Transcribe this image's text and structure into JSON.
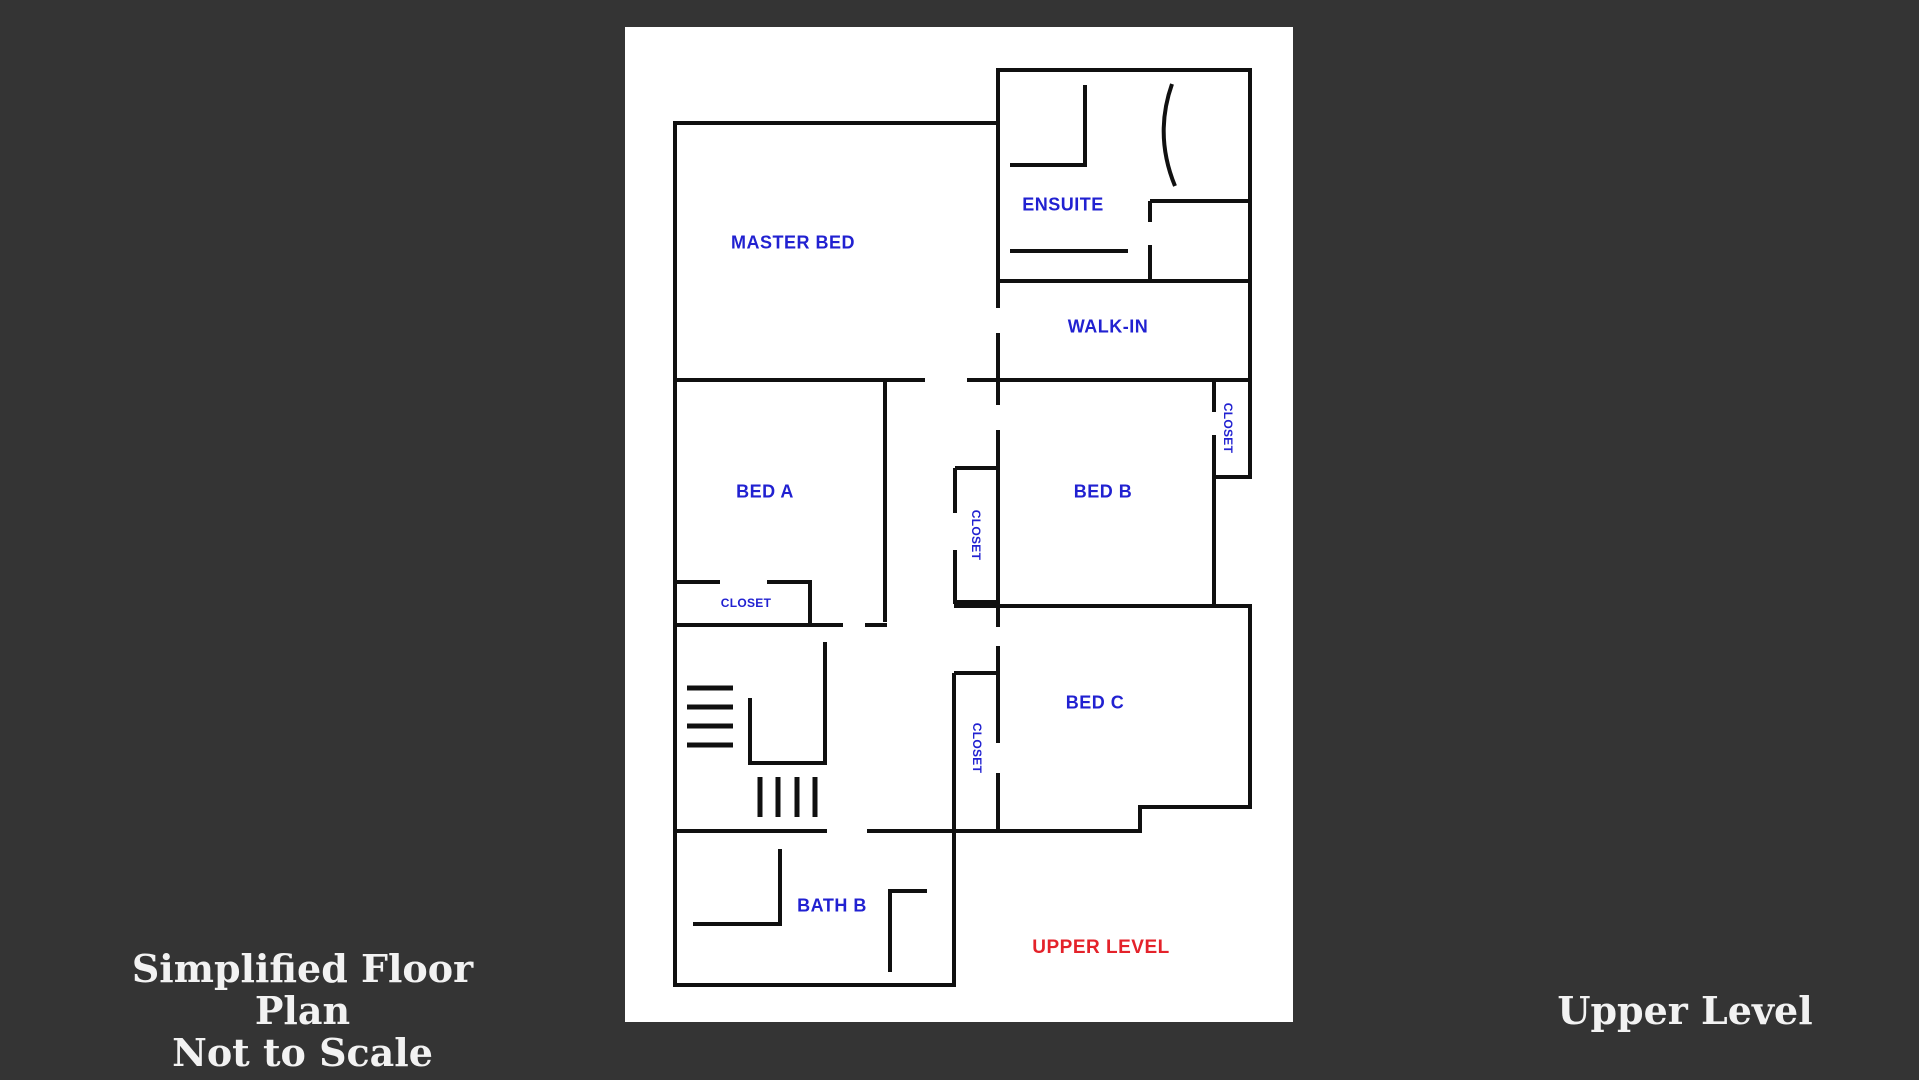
{
  "palette": {
    "background": "#343434",
    "paper": "#ffffff",
    "walls": "#101010",
    "room_label_blue": "#2121d1",
    "floor_label_red": "#e4222a",
    "caption_white": "#f2f2f2"
  },
  "captions": {
    "title_line1": "Simplified Floor Plan",
    "title_line2": "Not to Scale",
    "level_name": "Upper Level"
  },
  "floor_plan": {
    "floor_tag": {
      "text": "UPPER LEVEL",
      "color": "#e4222a"
    },
    "labels": {
      "master_bed": {
        "text": "MASTER BED"
      },
      "ensuite": {
        "text": "ENSUITE"
      },
      "walk_in": {
        "text": "WALK-IN"
      },
      "bed_a": {
        "text": "BED A"
      },
      "bed_b": {
        "text": "BED B"
      },
      "bed_c": {
        "text": "BED C"
      },
      "bath_b": {
        "text": "BATH B"
      },
      "closet_bed_a": {
        "text": "CLOSET",
        "orientation": "horizontal"
      },
      "closet_center": {
        "text": "CLOSET",
        "orientation": "vertical"
      },
      "closet_bed_b": {
        "text": "CLOSET",
        "orientation": "vertical"
      },
      "closet_bed_c": {
        "text": "CLOSET",
        "orientation": "vertical"
      }
    }
  }
}
